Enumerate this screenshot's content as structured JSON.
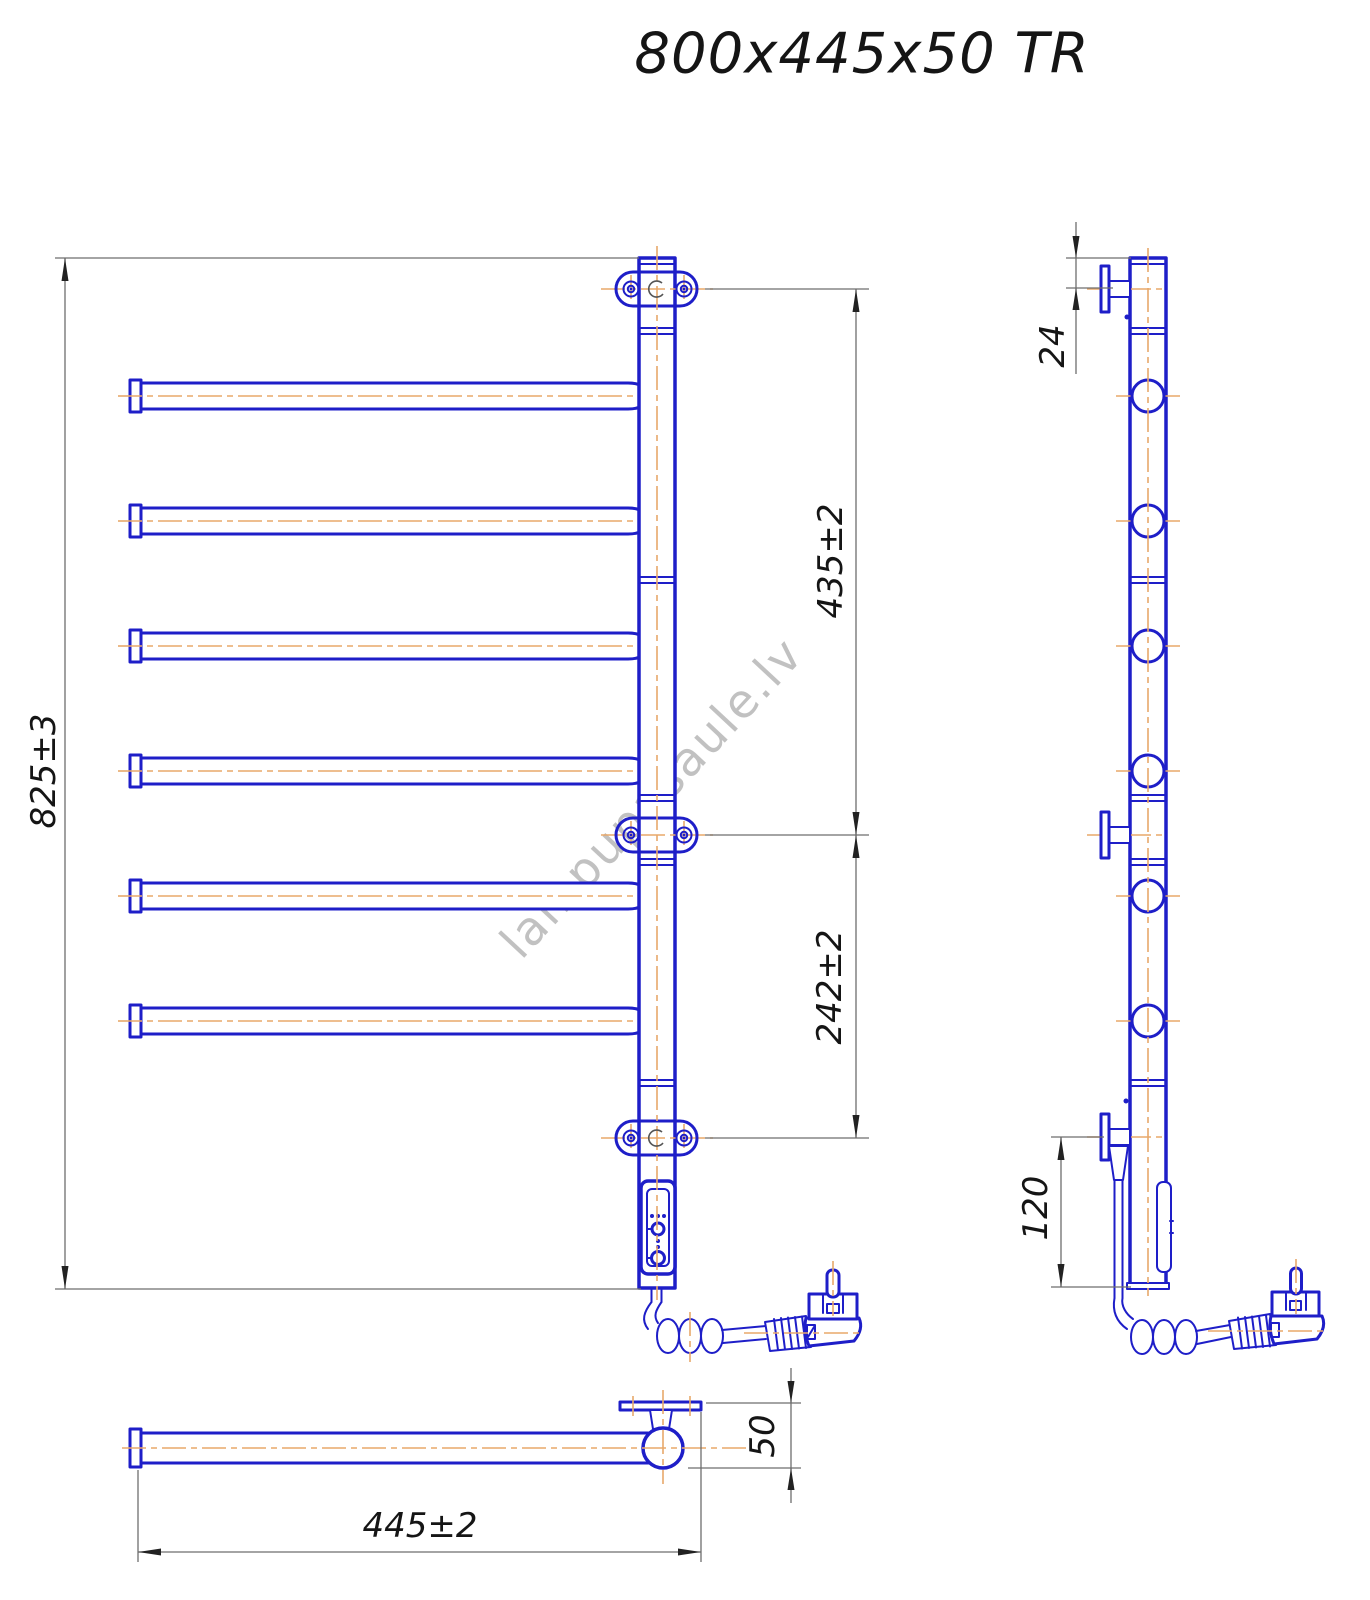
{
  "title": "800x445x50 TR",
  "watermark": "lampupasaule.lv",
  "dimensions": {
    "overall_height": "825±3",
    "upper_section": "435±2",
    "lower_section": "242±2",
    "bracket_top_offset": "24",
    "bracket_bottom_offset": "120",
    "rail_depth": "50",
    "overall_width": "445±2"
  },
  "colors": {
    "line_blue": "#1e1ec8",
    "centerline_orange": "#e8a86a",
    "dimension_gray": "#6e6e6e",
    "text_black": "#151515",
    "watermark_gray": "#8f8f8f"
  }
}
